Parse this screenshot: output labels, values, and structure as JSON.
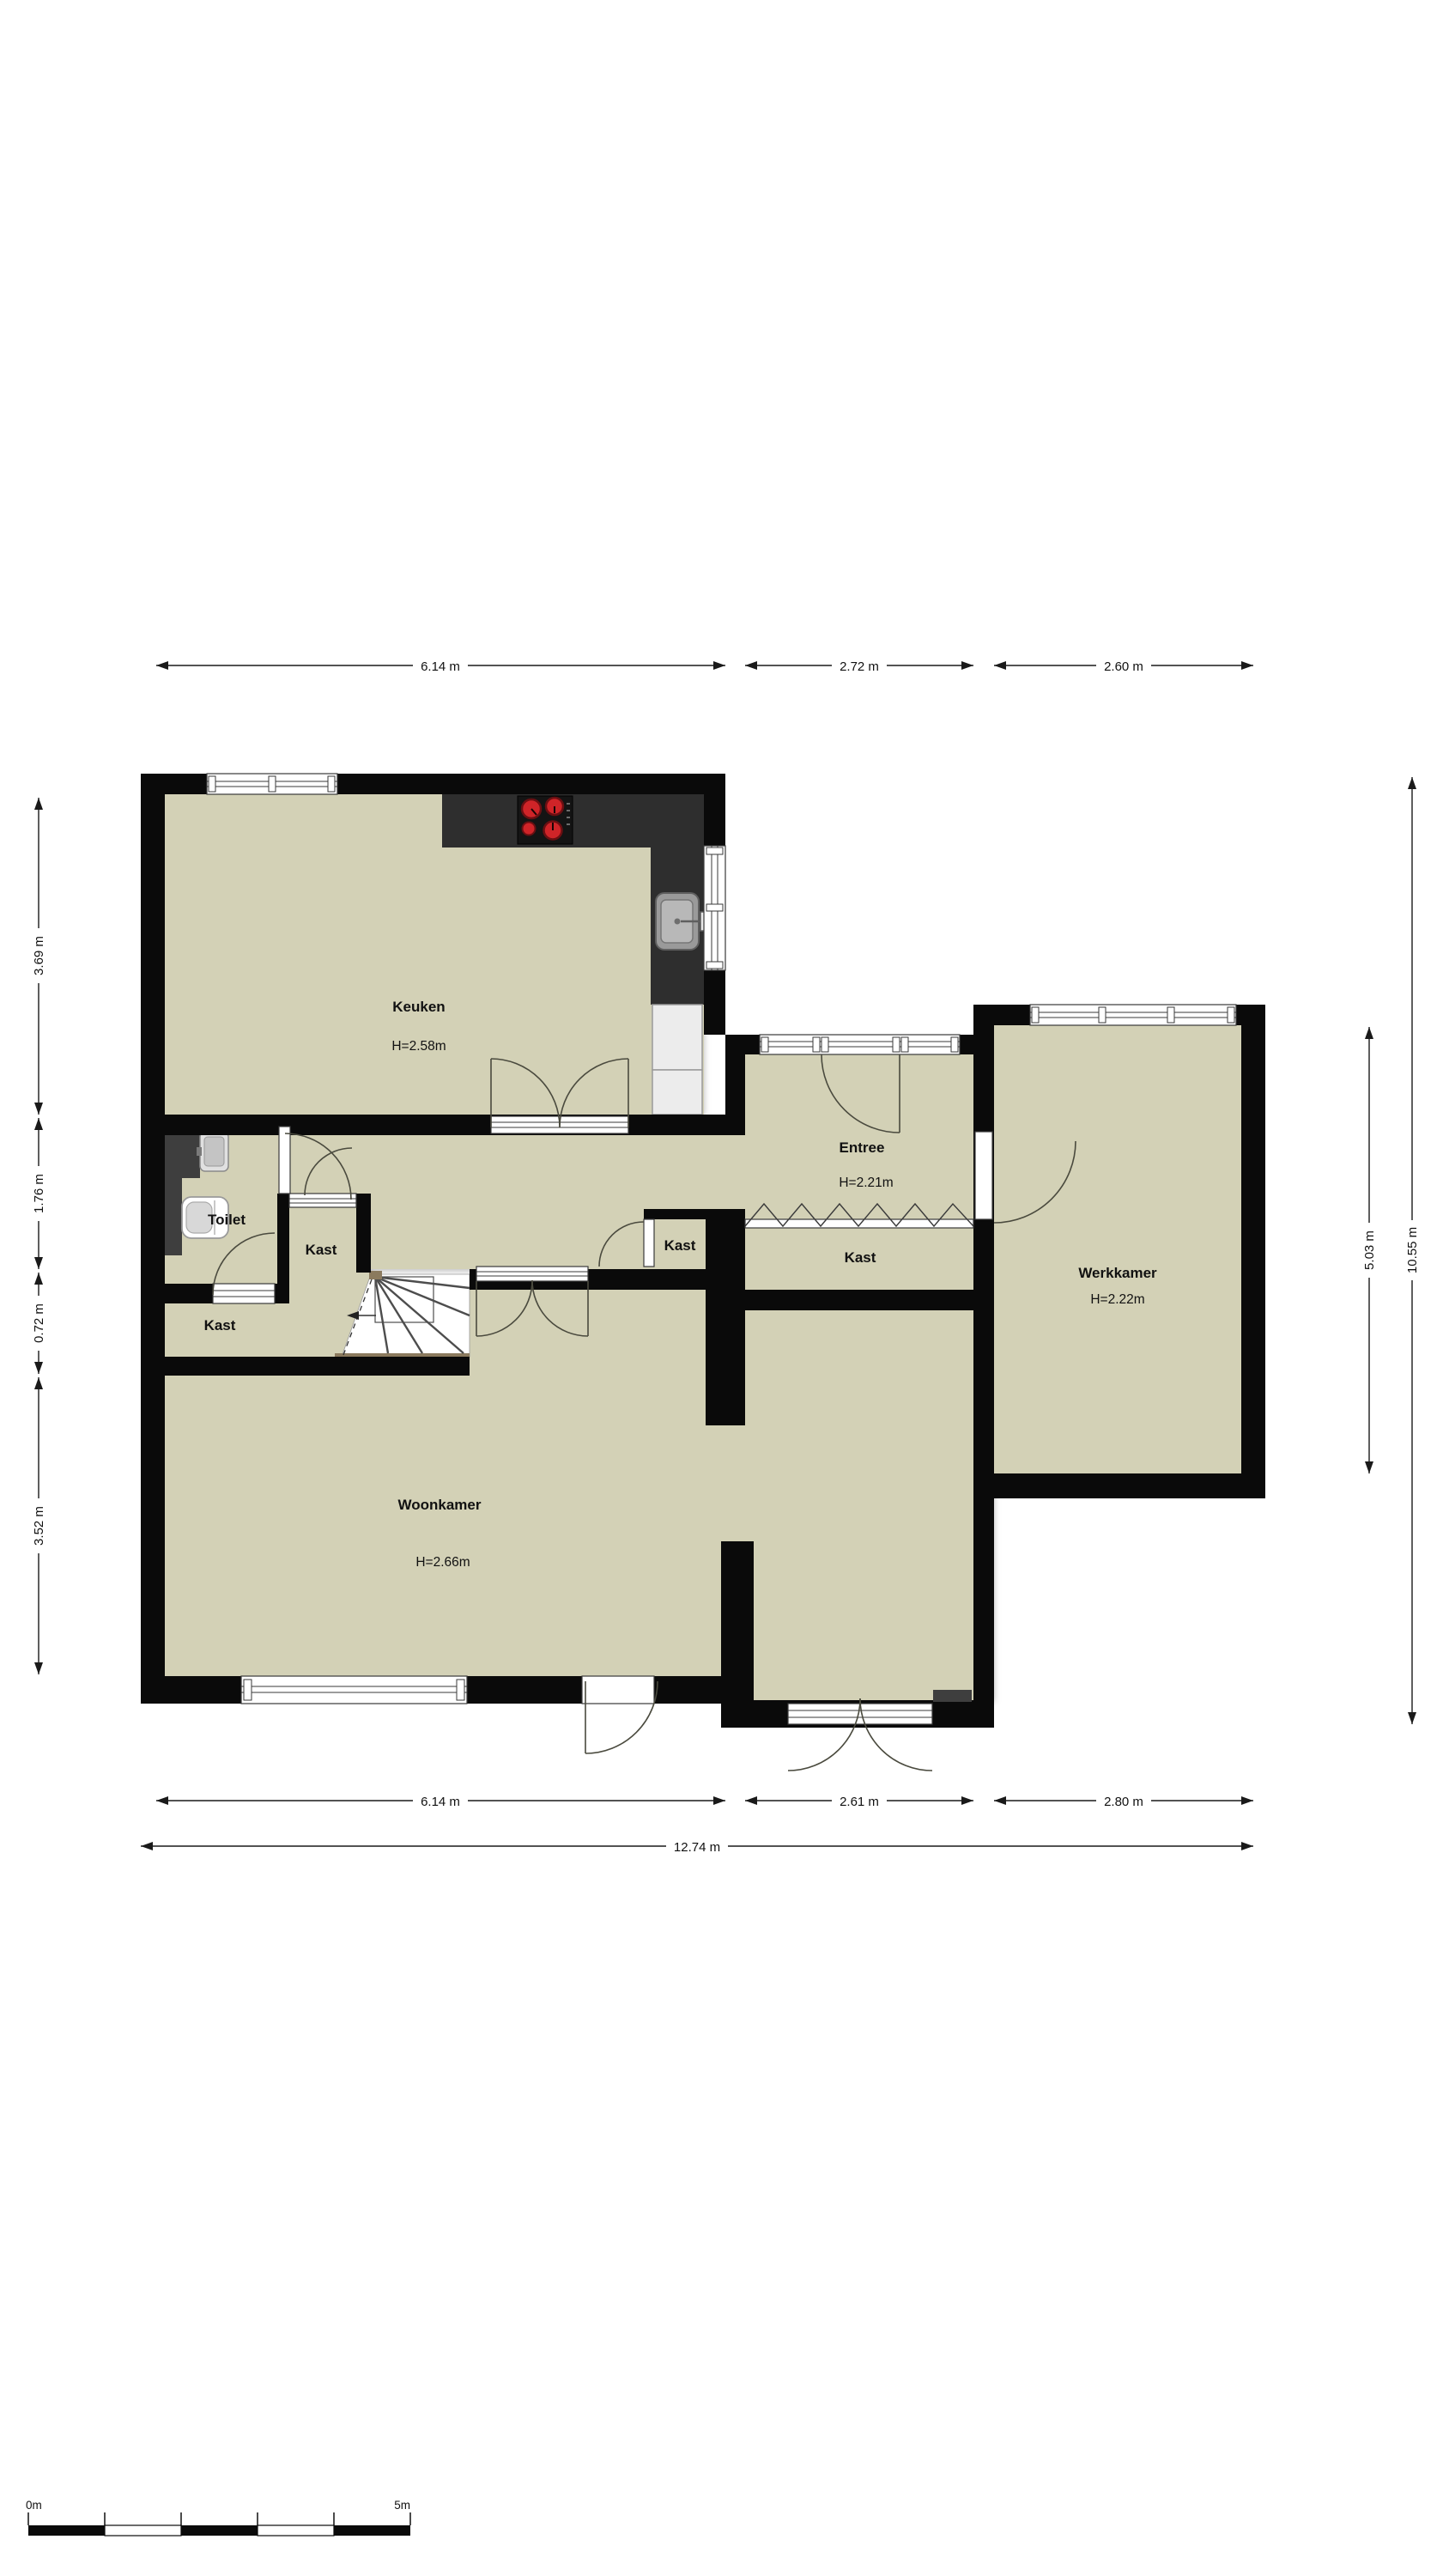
{
  "plan": {
    "rooms": {
      "keuken": {
        "name": "Keuken",
        "height": "H=2.58m"
      },
      "entree": {
        "name": "Entree",
        "height": "H=2.21m"
      },
      "werkkamer": {
        "name": "Werkkamer",
        "height": "H=2.22m"
      },
      "woonkamer": {
        "name": "Woonkamer",
        "height": "H=2.66m"
      },
      "toilet": {
        "name": "Toilet"
      },
      "kast": {
        "name": "Kast"
      }
    },
    "dimensions": {
      "top": [
        "6.14 m",
        "2.72 m",
        "2.60 m"
      ],
      "left": [
        "3.69 m",
        "1.76 m",
        "0.72 m",
        "3.52 m"
      ],
      "right": [
        "5.03 m",
        "10.55 m"
      ],
      "bottom": [
        "6.14 m",
        "2.61 m",
        "2.80 m"
      ],
      "total_bottom": "12.74 m"
    },
    "scale_bar": {
      "start_label": "0m",
      "end_label": "5m"
    },
    "colors": {
      "floor": "#d3d1b6",
      "wall": "#0a0a0a",
      "counter": "#2e2e2e",
      "burner_red": "#cf2428",
      "stair_edge": "#8b7a5e"
    }
  }
}
